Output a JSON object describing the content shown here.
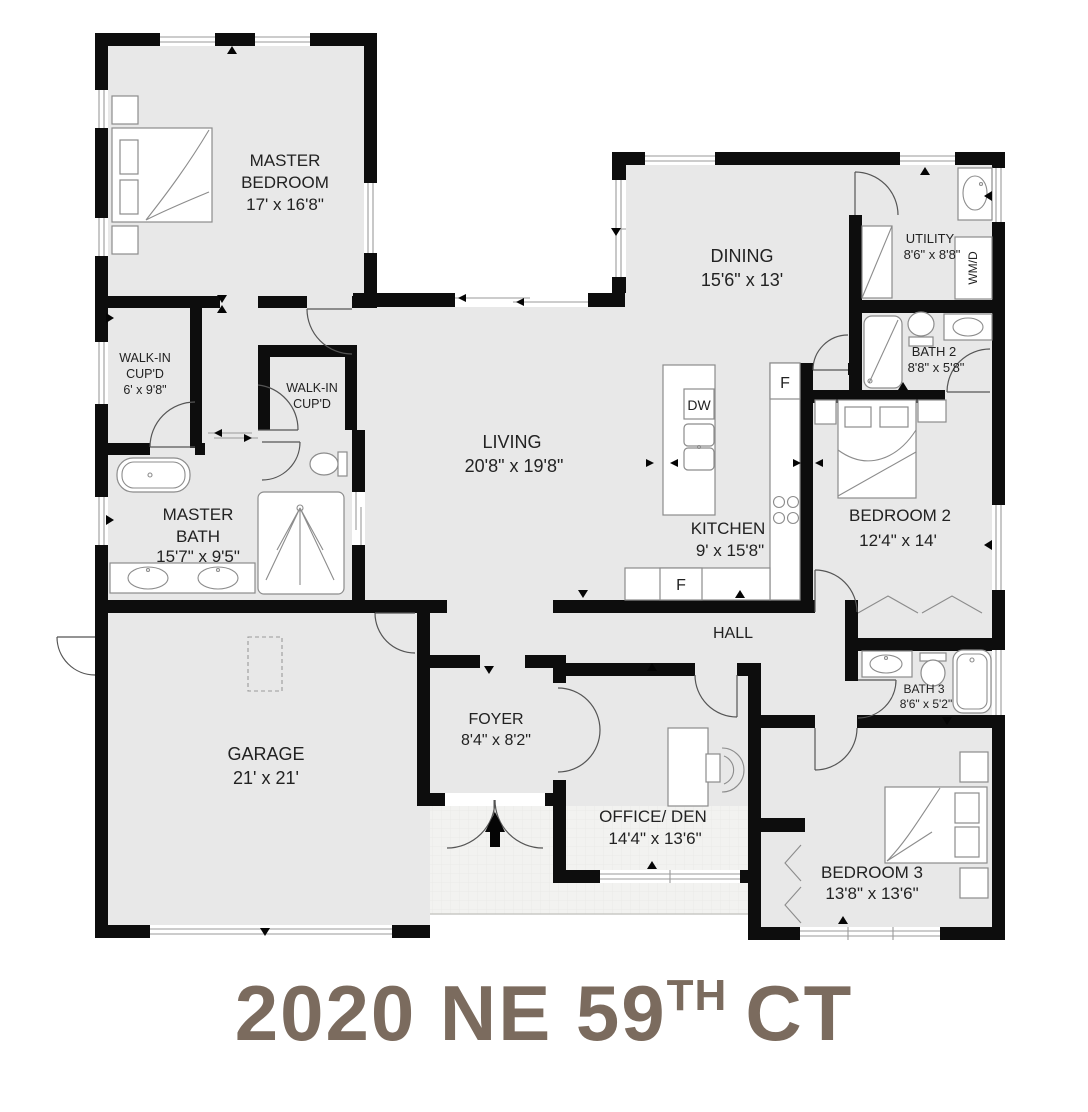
{
  "address": {
    "main": "2020 NE 59",
    "ordinal": "TH",
    "suffix": "CT"
  },
  "plan": {
    "rooms": {
      "master_bedroom": {
        "name1": "MASTER",
        "name2": "BEDROOM",
        "dims": "17' x 16'8\""
      },
      "walk_in_1": {
        "name1": "WALK-IN",
        "name2": "CUP'D",
        "dims": "6' x 9'8\""
      },
      "walk_in_2": {
        "name1": "WALK-IN",
        "name2": "CUP'D"
      },
      "master_bath": {
        "name1": "MASTER",
        "name2": "BATH",
        "dims": "15'7\" x 9'5\""
      },
      "garage": {
        "name": "GARAGE",
        "dims": "21' x 21'"
      },
      "living": {
        "name": "LIVING",
        "dims": "20'8\" x 19'8\""
      },
      "dining": {
        "name": "DINING",
        "dims": "15'6\" x 13'"
      },
      "kitchen": {
        "name": "KITCHEN",
        "dims": "9' x 15'8\""
      },
      "utility": {
        "name": "UTILITY",
        "dims": "8'6\" x 8'8\""
      },
      "bath2": {
        "name": "BATH 2",
        "dims": "8'8\" x 5'8\""
      },
      "bedroom2": {
        "name": "BEDROOM 2",
        "dims": "12'4\" x 14'"
      },
      "hall": {
        "name": "HALL"
      },
      "foyer": {
        "name": "FOYER",
        "dims": "8'4\" x 8'2\""
      },
      "office_den": {
        "name": "OFFICE/ DEN",
        "dims": "14'4\" x 13'6\""
      },
      "bath3": {
        "name": "BATH 3",
        "dims": "8'6\" x 5'2\""
      },
      "bedroom3": {
        "name": "BEDROOM 3",
        "dims": "13'8\" x 13'6\""
      }
    },
    "appliances": {
      "dishwasher": "DW",
      "fridge": "F",
      "washer_dryer": "WM/D"
    }
  },
  "colors": {
    "wall": "#0d0d0d",
    "floor": "#e8e8e8",
    "porch": "#f2f2f0",
    "title": "#7b6b5e"
  }
}
